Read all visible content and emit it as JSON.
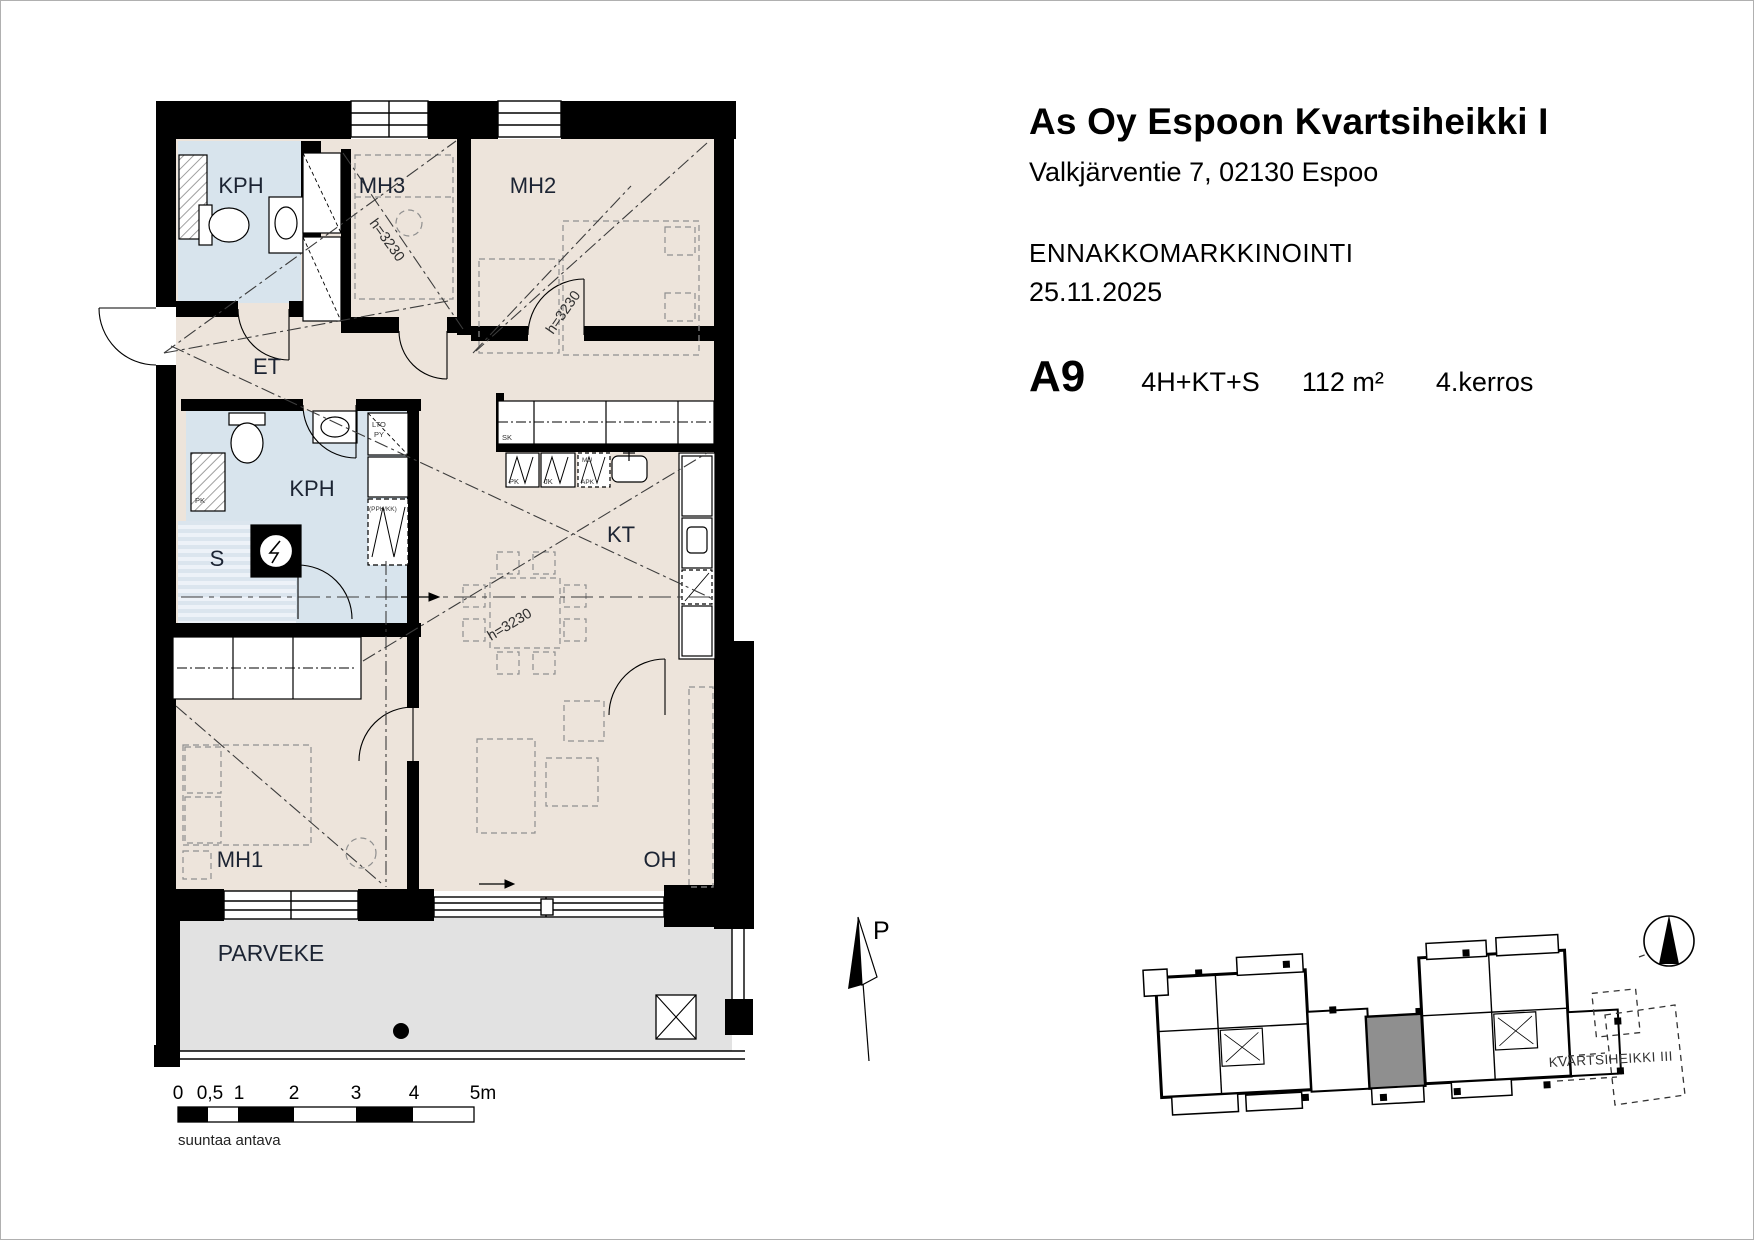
{
  "header": {
    "title": "As Oy Espoon Kvartsiheikki I",
    "address": "Valkjärventie 7, 02130 Espoo",
    "phase": "ENNAKKOMARKKINOINTI",
    "date": "25.11.2025",
    "apartment": {
      "id": "A9",
      "rooms": "4H+KT+S",
      "area": "112 m²",
      "floor": "4.kerros"
    }
  },
  "floorplan": {
    "rooms": {
      "kph_top": "KPH",
      "mh3": "MH3",
      "mh2": "MH2",
      "et": "ET",
      "kph": "KPH",
      "sauna": "S",
      "kt": "KT",
      "mh1": "MH1",
      "oh": "OH",
      "parveke": "PARVEKE"
    },
    "height_note": "h=3230",
    "labels": {
      "sk": "SK",
      "lto": "LTO",
      "py": "PY",
      "ppk_kk": "(PPK/KK)",
      "pk": "PK",
      "jk": "JK",
      "mu": "MU",
      "apk": "APK",
      "washer": "PK"
    }
  },
  "scalebar": {
    "labels": [
      "0",
      "0,5",
      "1",
      "2",
      "3",
      "4",
      "5m"
    ],
    "disclaimer": "suuntaa antava"
  },
  "north_label": "P",
  "siteplan": {
    "neighbor_label": "KVARTSIHEIKKI III"
  },
  "colors": {
    "floor": "#EDE4DB",
    "wet_room": "#D8E4ED",
    "balcony": "#E2E2E2",
    "walls": "#000000",
    "site_highlight": "#8F8F8F"
  }
}
